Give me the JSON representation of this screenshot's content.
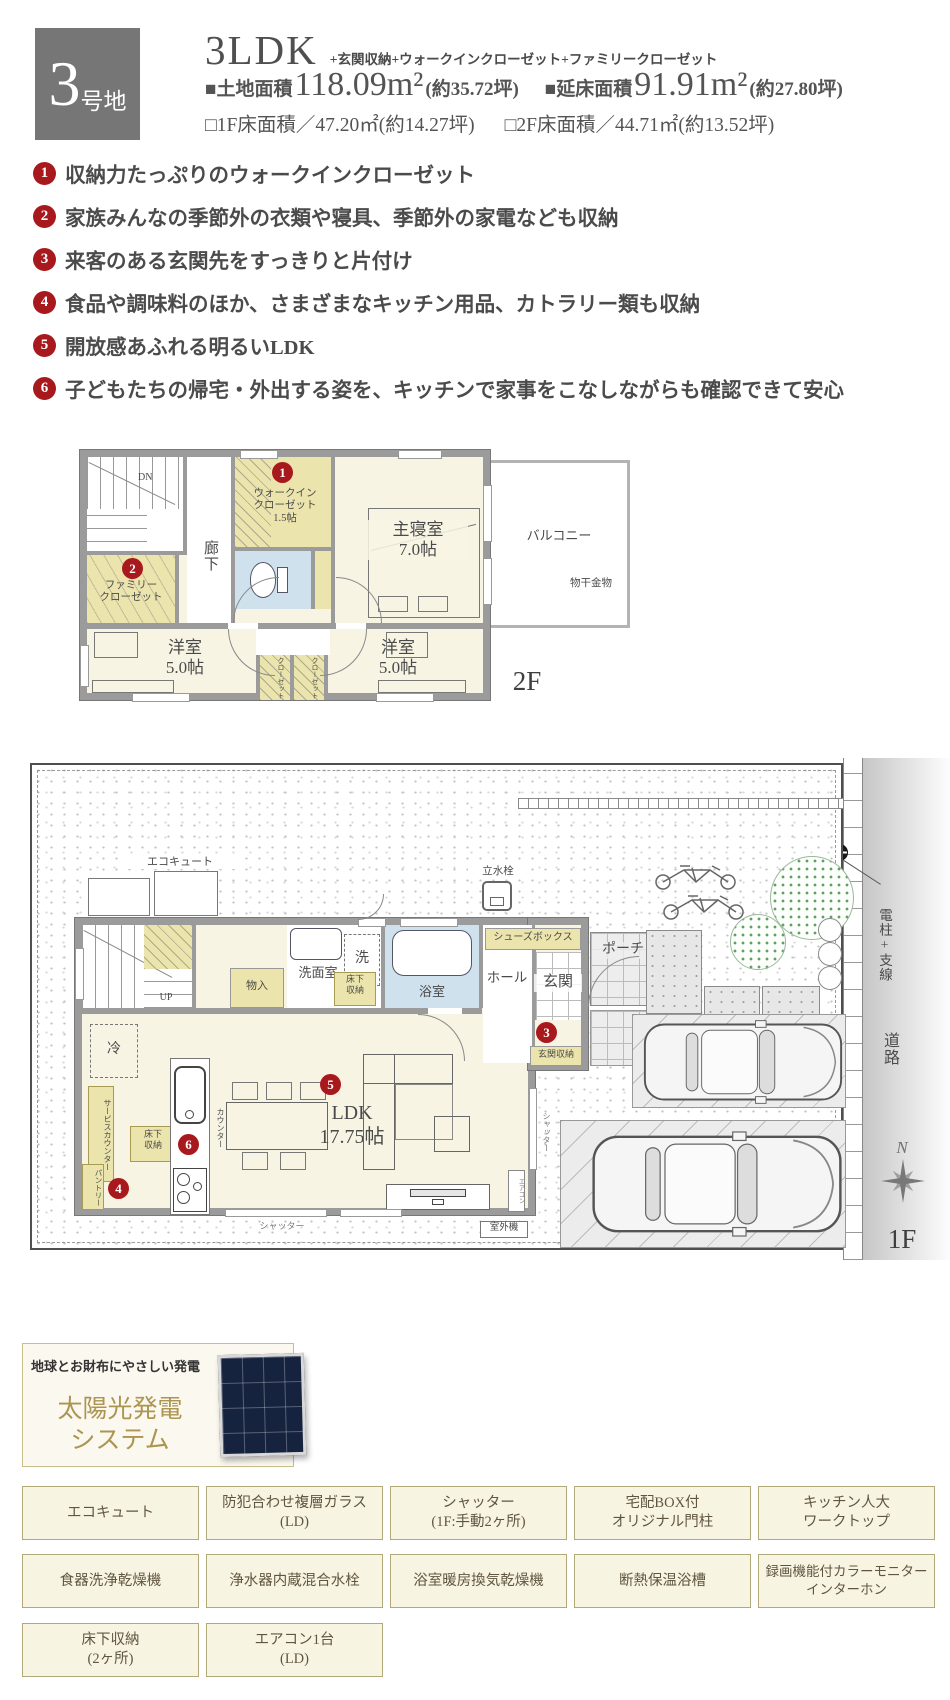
{
  "header": {
    "lot_number": "3",
    "lot_suffix": "号地",
    "plan_type": "3LDK",
    "plan_extras": "+玄関収納+ウォークインクローゼット+ファミリークローゼット",
    "land_label": "■土地面積",
    "land_value": "118.09m²",
    "land_tsubo": "(約35.72坪)",
    "total_label": "■延床面積",
    "total_value": "91.91m²",
    "total_tsubo": "(約27.80坪)",
    "floor1": "□1F床面積／47.20㎡(約14.27坪)",
    "floor2": "□2F床面積／44.71㎡(約13.52坪)"
  },
  "features": [
    {
      "n": "1",
      "text": "収納力たっぷりのウォークインクローゼット"
    },
    {
      "n": "2",
      "text": "家族みんなの季節外の衣類や寝具、季節外の家電なども収納"
    },
    {
      "n": "3",
      "text": "来客のある玄関先をすっきりと片付け"
    },
    {
      "n": "4",
      "text": "食品や調味料のほか、さまざまなキッチン用品、カトラリー類も収納"
    },
    {
      "n": "5",
      "text": "開放感あふれる明るいLDK"
    },
    {
      "n": "6",
      "text": "子どもたちの帰宅・外出する姿を、キッチンで家事をこなしながらも確認できて安心"
    }
  ],
  "plan2f": {
    "floor": "2F",
    "dn": "DN",
    "hallway": "廊下",
    "wic": "ウォークイン\nクローゼット\n1.5帖",
    "master": "主寝室\n7.0帖",
    "family_closet": "ファミリー\nクローゼット",
    "west_left": "洋室\n5.0帖",
    "west_right": "洋室\n5.0帖",
    "closet1": "クローゼット",
    "closet2": "クローゼット",
    "balcony": "バルコニー",
    "drying": "物干金物",
    "b1": "1",
    "b2": "2"
  },
  "plan1f": {
    "floor": "1F",
    "ecocute": "エコキュート",
    "tap": "立水栓",
    "up": "UP",
    "storage": "物入",
    "washroom": "洗面室",
    "washer": "洗",
    "underfloor1": "床下\n収納",
    "bath": "浴室",
    "hall": "ホール",
    "shoebox": "シューズボックス",
    "entrance": "玄関",
    "porch": "ポーチ",
    "entrance_storage": "玄関収納",
    "fridge": "冷",
    "service_counter": "サービスカウンター",
    "pantry": "パントリー",
    "underfloor2": "床下\n収納",
    "counter": "カウンター",
    "ldk": "LDK\n17.75帖",
    "aircon": "エアコン",
    "shutter1": "シャッター",
    "shutter2": "シャッター",
    "outdoor": "室外機",
    "pole": "電柱+支線",
    "road": "道路",
    "north": "N",
    "b3": "3",
    "b4": "4",
    "b5": "5",
    "b6": "6"
  },
  "solar": {
    "catch": "地球とお財布にやさしい発電",
    "title": "太陽光発電\nシステム"
  },
  "equipment": {
    "r1": [
      "エコキュート",
      "防犯合わせ複層ガラス\n(LD)",
      "シャッター\n(1F:手動2ヶ所)",
      "宅配BOX付\nオリジナル門柱",
      "キッチン人大\nワークトップ"
    ],
    "r2": [
      "食器洗浄乾燥機",
      "浄水器内蔵混合水栓",
      "浴室暖房換気乾燥機",
      "断熱保温浴槽",
      "録画機能付カラーモニター\nインターホン"
    ],
    "r3": [
      "床下収納\n(2ヶ所)",
      "エアコン1台\n(LD)"
    ]
  }
}
